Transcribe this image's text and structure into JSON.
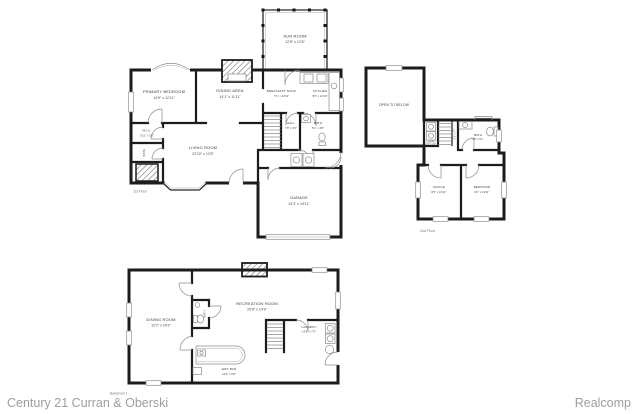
{
  "colors": {
    "walls": "#1c1c1c",
    "thin_lines": "#8c8c8c",
    "label_text": "#3c3c3c",
    "footer_text": "#9e9e9e"
  },
  "footer": {
    "left": "Century 21 Curran & Oberski",
    "right": "Realcomp"
  },
  "floors": {
    "first": {
      "label": "1st Floor",
      "rooms": {
        "sun_room": {
          "name": "SUN ROOM",
          "dims": "12'8\" x 12'6\""
        },
        "primary_bedroom": {
          "name": "PRIMARY BEDROOM",
          "dims": "14'9\" x 12'11\""
        },
        "dining_area": {
          "name": "DINING AREA",
          "dims": "14'1\" x 11'11\""
        },
        "breakfast_nook": {
          "name": "BREAKFAST NOOK",
          "dims": "7'1\" x 12'10\""
        },
        "kitchen": {
          "name": "KITCHEN",
          "dims": "9'5\" x 12'10\""
        },
        "wic": {
          "name": "W.I.C.",
          "dims": "5'11\" x 3'3\""
        },
        "bath_primary": {
          "name": "BATH"
        },
        "hall": {
          "name": "HALL",
          "dims": "7'8\" x 3'3\""
        },
        "bath_hall": {
          "name": "BATH",
          "dims": "5'1\" x 4'8\""
        },
        "living_room": {
          "name": "LIVING ROOM",
          "dims": "22'10\" x 13'5\""
        },
        "garage": {
          "name": "GARAGE",
          "dims": "19'3\" x 19'11\""
        }
      }
    },
    "second": {
      "label": "2nd Floor",
      "rooms": {
        "open_to_below": {
          "name": "OPEN TO BELOW"
        },
        "laundry_closet": {
          "name": "LNDRY",
          "dims": "3'4\" x 4'1\""
        },
        "hall": {
          "dims": "5'1\" x 7'7\""
        },
        "bath": {
          "name": "BATH",
          "dims": "9'8\" x 5'1\""
        },
        "office": {
          "name": "OFFICE",
          "dims": "8'6\" x 10'11\""
        },
        "bedroom": {
          "name": "BEDROOM",
          "dims": "9'2\" x 10'11\""
        }
      }
    },
    "basement": {
      "label": "Basement 1",
      "rooms": {
        "dining_room": {
          "name": "DINING ROOM",
          "dims": "12'2\" x 24'2\""
        },
        "recreation_room": {
          "name": "RECREATION ROOM",
          "dims": "25'8\" x 14'9\""
        },
        "bath": {
          "name": "BATH"
        },
        "laundry": {
          "name": "LAUNDRY",
          "dims": "13'6\" x 7'5\""
        },
        "wet_bar": {
          "name": "WET BAR",
          "dims": "14'0\" x 6'8\""
        }
      }
    }
  }
}
